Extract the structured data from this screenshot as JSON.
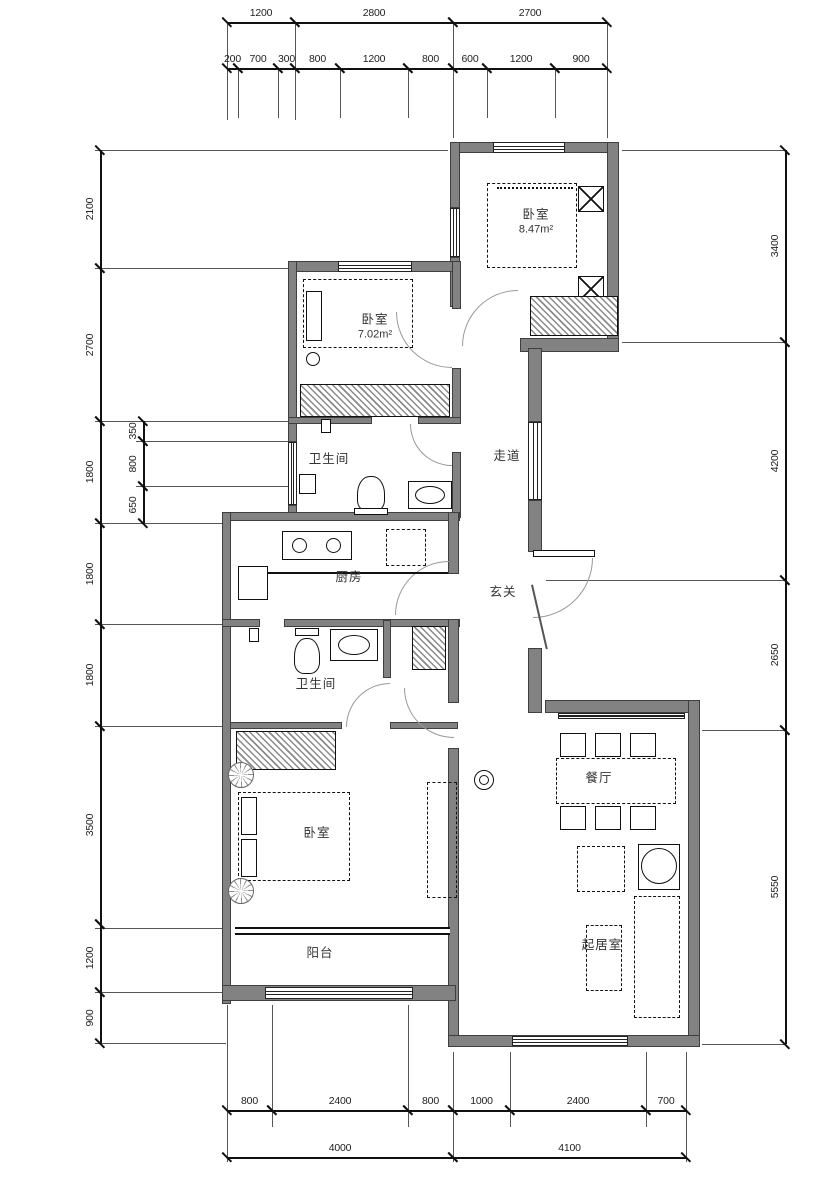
{
  "drawing": {
    "type": "apartment-floor-plan"
  },
  "rooms": [
    {
      "name": "bedroom-northeast",
      "label": "卧室",
      "area": "8.47m²",
      "cx": 536,
      "cy": 222
    },
    {
      "name": "bedroom-north",
      "label": "卧室",
      "area": "7.02m²",
      "cx": 375,
      "cy": 327
    },
    {
      "name": "bathroom-upper",
      "label": "卫生间",
      "area": "",
      "cx": 329,
      "cy": 459
    },
    {
      "name": "corridor",
      "label": "走道",
      "area": "",
      "cx": 507,
      "cy": 456
    },
    {
      "name": "kitchen",
      "label": "厨房",
      "area": "",
      "cx": 349,
      "cy": 577
    },
    {
      "name": "foyer",
      "label": "玄关",
      "area": "",
      "cx": 503,
      "cy": 592
    },
    {
      "name": "bathroom-lower",
      "label": "卫生间",
      "area": "",
      "cx": 316,
      "cy": 684
    },
    {
      "name": "dining-room",
      "label": "餐厅",
      "area": "",
      "cx": 599,
      "cy": 778
    },
    {
      "name": "bedroom-southwest",
      "label": "卧室",
      "area": "",
      "cx": 317,
      "cy": 833
    },
    {
      "name": "living-room",
      "label": "起居室",
      "area": "",
      "cx": 602,
      "cy": 945
    },
    {
      "name": "balcony",
      "label": "阳台",
      "area": "",
      "cx": 320,
      "cy": 953
    }
  ],
  "dimensions": {
    "top_overall": {
      "orient": "h",
      "y": 22,
      "segments": [
        {
          "value": "1200",
          "from": 227,
          "to": 295
        },
        {
          "value": "2800",
          "from": 295,
          "to": 453
        },
        {
          "value": "2700",
          "from": 453,
          "to": 607
        }
      ]
    },
    "top_detail": {
      "orient": "h",
      "y": 68,
      "segments": [
        {
          "value": "200",
          "from": 227,
          "to": 238
        },
        {
          "value": "700",
          "from": 238,
          "to": 278
        },
        {
          "value": "300",
          "from": 278,
          "to": 295
        },
        {
          "value": "800",
          "from": 295,
          "to": 340
        },
        {
          "value": "1200",
          "from": 340,
          "to": 408
        },
        {
          "value": "800",
          "from": 408,
          "to": 453
        },
        {
          "value": "600",
          "from": 453,
          "to": 487
        },
        {
          "value": "1200",
          "from": 487,
          "to": 555
        },
        {
          "value": "900",
          "from": 555,
          "to": 607
        }
      ]
    },
    "left_main": {
      "orient": "v",
      "x": 100,
      "segments": [
        {
          "value": "2100",
          "from": 150,
          "to": 268
        },
        {
          "value": "2700",
          "from": 268,
          "to": 421
        },
        {
          "value": "1800",
          "from": 421,
          "to": 523
        },
        {
          "value": "1800",
          "from": 523,
          "to": 624
        },
        {
          "value": "1800",
          "from": 624,
          "to": 726
        },
        {
          "value": "3500",
          "from": 726,
          "to": 924
        },
        {
          "value": "1200",
          "from": 924,
          "to": 992
        },
        {
          "value": "900",
          "from": 992,
          "to": 1043
        }
      ]
    },
    "left_detail": {
      "orient": "v",
      "x": 143,
      "segments": [
        {
          "value": "350",
          "from": 421,
          "to": 441
        },
        {
          "value": "800",
          "from": 441,
          "to": 486
        },
        {
          "value": "650",
          "from": 486,
          "to": 523
        }
      ]
    },
    "right_main": {
      "orient": "v",
      "x": 785,
      "segments": [
        {
          "value": "3400",
          "from": 150,
          "to": 342
        },
        {
          "value": "4200",
          "from": 342,
          "to": 580
        },
        {
          "value": "2650",
          "from": 580,
          "to": 730
        },
        {
          "value": "5550",
          "from": 730,
          "to": 1044
        }
      ]
    },
    "bottom_detail": {
      "orient": "h",
      "y": 1110,
      "segments": [
        {
          "value": "800",
          "from": 227,
          "to": 272
        },
        {
          "value": "2400",
          "from": 272,
          "to": 408
        },
        {
          "value": "800",
          "from": 408,
          "to": 453
        },
        {
          "value": "1000",
          "from": 453,
          "to": 510
        },
        {
          "value": "2400",
          "from": 510,
          "to": 646
        },
        {
          "value": "700",
          "from": 646,
          "to": 686
        }
      ]
    },
    "bottom_overall": {
      "orient": "h",
      "y": 1157,
      "segments": [
        {
          "value": "4000",
          "from": 227,
          "to": 453
        },
        {
          "value": "4100",
          "from": 453,
          "to": 686
        }
      ]
    }
  },
  "colors": {
    "wall": "#828282",
    "line": "#111111",
    "dim_text": "#222222"
  }
}
